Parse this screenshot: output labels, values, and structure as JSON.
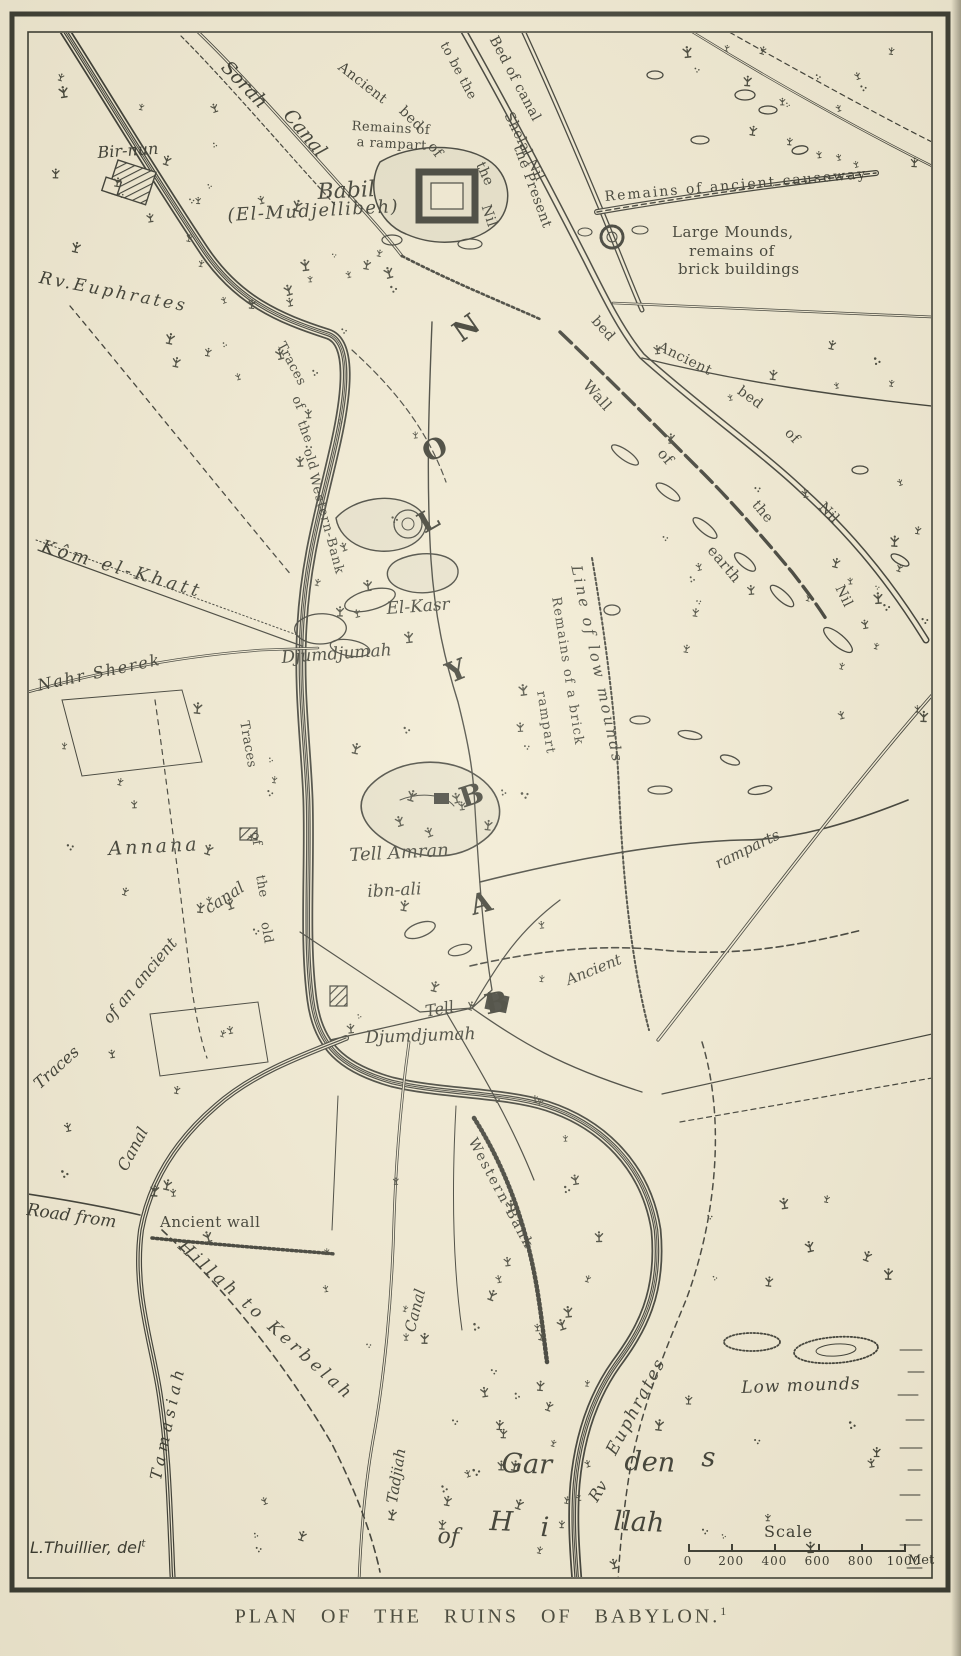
{
  "title_caption": {
    "text": "PLAN OF THE RUINS OF BABYLON.",
    "superscript": "1"
  },
  "credit": {
    "text": "L.Thuillier, del",
    "superscript": "t"
  },
  "scale_bar": {
    "label": "Scale",
    "ticks": [
      "0",
      "200",
      "400",
      "600",
      "800",
      "1000"
    ],
    "unit": "Met"
  },
  "colors": {
    "paper": "#f1ead3",
    "ink": "#30312a"
  },
  "map_labels": [
    {
      "t": "Sorah",
      "x": 231,
      "y": 58,
      "r": 46,
      "s": 19,
      "c": "ital"
    },
    {
      "t": "Canal",
      "x": 294,
      "y": 106,
      "r": 50,
      "s": 19,
      "c": "ital"
    },
    {
      "t": "Ancient",
      "x": 344,
      "y": 60,
      "r": 38,
      "s": 14,
      "c": "rom"
    },
    {
      "t": "bed",
      "x": 406,
      "y": 104,
      "r": 44,
      "s": 14,
      "c": "rom"
    },
    {
      "t": "of",
      "x": 436,
      "y": 140,
      "r": 52,
      "s": 14,
      "c": "rom"
    },
    {
      "t": "the",
      "x": 486,
      "y": 160,
      "r": 66,
      "s": 14,
      "c": "rom"
    },
    {
      "t": "Nil",
      "x": 492,
      "y": 203,
      "r": 72,
      "s": 14,
      "c": "rom"
    },
    {
      "t": "Bed of canal",
      "x": 499,
      "y": 34,
      "r": 62,
      "s": 14,
      "c": "rom"
    },
    {
      "t": "to be the",
      "x": 449,
      "y": 40,
      "r": 62,
      "s": 13,
      "c": "rom"
    },
    {
      "t": "Shelal Nil",
      "x": 514,
      "y": 110,
      "r": 64,
      "s": 14,
      "c": "rom"
    },
    {
      "t": "the Present",
      "x": 524,
      "y": 143,
      "r": 70,
      "s": 14,
      "c": "rom"
    },
    {
      "t": "Remains of",
      "x": 352,
      "y": 120,
      "r": 3,
      "s": 13,
      "c": "rom"
    },
    {
      "t": "a rampart",
      "x": 357,
      "y": 136,
      "r": 3,
      "s": 13,
      "c": "rom"
    },
    {
      "t": "Babil",
      "x": 317,
      "y": 182,
      "r": -3,
      "s": 22,
      "c": "ital"
    },
    {
      "t": "(El-Mudjellibeh)",
      "x": 227,
      "y": 207,
      "r": -3,
      "s": 18,
      "c": "ital",
      "ls": 1.5
    },
    {
      "t": "Bir-nun",
      "x": 97,
      "y": 145,
      "r": -4,
      "s": 16,
      "c": "ital"
    },
    {
      "t": "Remains of ancient causeway",
      "x": 604,
      "y": 190,
      "r": -5,
      "s": 14,
      "c": "rom",
      "ls": 2
    },
    {
      "t": "Large Mounds,",
      "x": 672,
      "y": 225,
      "r": 0,
      "s": 15,
      "c": "rom"
    },
    {
      "t": "remains of",
      "x": 689,
      "y": 244,
      "r": 0,
      "s": 15,
      "c": "rom"
    },
    {
      "t": "brick buildings",
      "x": 678,
      "y": 262,
      "r": 0,
      "s": 15,
      "c": "rom"
    },
    {
      "t": "Rv.Euphrates",
      "x": 41,
      "y": 270,
      "r": 11,
      "s": 17,
      "c": "ital",
      "ls": 3
    },
    {
      "t": "Traces",
      "x": 286,
      "y": 340,
      "r": 62,
      "s": 13,
      "c": "rom"
    },
    {
      "t": "of",
      "x": 301,
      "y": 394,
      "r": 66,
      "s": 13,
      "c": "rom"
    },
    {
      "t": "the",
      "x": 307,
      "y": 419,
      "r": 70,
      "s": 13,
      "c": "rom"
    },
    {
      "t": "old",
      "x": 313,
      "y": 447,
      "r": 72,
      "s": 13,
      "c": "rom"
    },
    {
      "t": "Western-Bank",
      "x": 319,
      "y": 472,
      "r": 75,
      "s": 13,
      "c": "rom",
      "ls": 1
    },
    {
      "t": "Kôm el-Khatt",
      "x": 44,
      "y": 538,
      "r": 16,
      "s": 18,
      "c": "ital",
      "ls": 4
    },
    {
      "t": "Nahr Sherek",
      "x": 36,
      "y": 678,
      "r": -12,
      "s": 16,
      "c": "ital",
      "ls": 2
    },
    {
      "t": "El-Kasr",
      "x": 386,
      "y": 601,
      "r": -4,
      "s": 17,
      "c": "ital"
    },
    {
      "t": "Djumdjumah",
      "x": 281,
      "y": 650,
      "r": -4,
      "s": 17,
      "c": "ital"
    },
    {
      "t": "Remains of a brick",
      "x": 562,
      "y": 596,
      "r": 81,
      "s": 13,
      "c": "rom",
      "ls": 1.5
    },
    {
      "t": "rampart",
      "x": 547,
      "y": 690,
      "r": 81,
      "s": 13,
      "c": "rom",
      "ls": 1.5
    },
    {
      "t": "Line of low mounds",
      "x": 583,
      "y": 564,
      "r": 78,
      "s": 15,
      "c": "ital",
      "ls": 3
    },
    {
      "t": "Wall",
      "x": 591,
      "y": 378,
      "r": 48,
      "s": 15,
      "c": "rom"
    },
    {
      "t": "of",
      "x": 666,
      "y": 446,
      "r": 50,
      "s": 15,
      "c": "rom"
    },
    {
      "t": "earth",
      "x": 716,
      "y": 543,
      "r": 50,
      "s": 15,
      "c": "rom"
    },
    {
      "t": "bed",
      "x": 599,
      "y": 314,
      "r": 48,
      "s": 14,
      "c": "rom"
    },
    {
      "t": "Ancient",
      "x": 662,
      "y": 340,
      "r": 26,
      "s": 14,
      "c": "rom"
    },
    {
      "t": "bed",
      "x": 743,
      "y": 384,
      "r": 36,
      "s": 14,
      "c": "rom"
    },
    {
      "t": "of",
      "x": 792,
      "y": 426,
      "r": 46,
      "s": 14,
      "c": "rom"
    },
    {
      "t": "the",
      "x": 760,
      "y": 498,
      "r": 50,
      "s": 14,
      "c": "rom"
    },
    {
      "t": "Nil",
      "x": 826,
      "y": 500,
      "r": 46,
      "s": 14,
      "c": "rom"
    },
    {
      "t": "Nil",
      "x": 845,
      "y": 583,
      "r": 64,
      "s": 14,
      "c": "rom"
    },
    {
      "t": "Annana",
      "x": 108,
      "y": 840,
      "r": -3,
      "s": 19,
      "c": "ital",
      "ls": 3
    },
    {
      "t": "Tell Amran",
      "x": 349,
      "y": 847,
      "r": -3,
      "s": 18,
      "c": "ital"
    },
    {
      "t": "ibn-ali",
      "x": 367,
      "y": 884,
      "r": -3,
      "s": 17,
      "c": "ital"
    },
    {
      "t": "Traces",
      "x": 250,
      "y": 720,
      "r": 80,
      "s": 13,
      "c": "rom"
    },
    {
      "t": "of",
      "x": 261,
      "y": 831,
      "r": 80,
      "s": 13,
      "c": "rom"
    },
    {
      "t": "the",
      "x": 266,
      "y": 874,
      "r": 80,
      "s": 13,
      "c": "rom"
    },
    {
      "t": "old",
      "x": 271,
      "y": 921,
      "r": 80,
      "s": 13,
      "c": "rom"
    },
    {
      "t": "canal",
      "x": 202,
      "y": 903,
      "r": -33,
      "s": 16,
      "c": "ital"
    },
    {
      "t": "of an ancient",
      "x": 100,
      "y": 1016,
      "r": -50,
      "s": 16,
      "c": "ital"
    },
    {
      "t": "Traces",
      "x": 31,
      "y": 1080,
      "r": -42,
      "s": 16,
      "c": "ital"
    },
    {
      "t": "ramparts",
      "x": 713,
      "y": 858,
      "r": -26,
      "s": 15,
      "c": "ital"
    },
    {
      "t": "Ancient",
      "x": 564,
      "y": 974,
      "r": -22,
      "s": 15,
      "c": "ital"
    },
    {
      "t": "Tell",
      "x": 424,
      "y": 1004,
      "r": -10,
      "s": 16,
      "c": "ital"
    },
    {
      "t": "Djumdjumah",
      "x": 365,
      "y": 1030,
      "r": -2,
      "s": 17,
      "c": "ital"
    },
    {
      "t": "Canal",
      "x": 115,
      "y": 1166,
      "r": -62,
      "s": 16,
      "c": "ital"
    },
    {
      "t": "Road from",
      "x": 28,
      "y": 1202,
      "r": 8,
      "s": 17,
      "c": "ital"
    },
    {
      "t": "Ancient wall",
      "x": 160,
      "y": 1215,
      "r": 0,
      "s": 15,
      "c": "rom"
    },
    {
      "t": "Hillah to Kerbelah",
      "x": 186,
      "y": 1238,
      "r": 42,
      "s": 17,
      "c": "ital",
      "ls": 4
    },
    {
      "t": "Tamasiah",
      "x": 148,
      "y": 1478,
      "r": -78,
      "s": 16,
      "c": "ital",
      "ls": 5
    },
    {
      "t": "Western-Bank",
      "x": 478,
      "y": 1136,
      "r": 62,
      "s": 14,
      "c": "rom",
      "ls": 2
    },
    {
      "t": "Canal",
      "x": 403,
      "y": 1330,
      "r": -76,
      "s": 15,
      "c": "ital"
    },
    {
      "t": "Tadjiah",
      "x": 385,
      "y": 1502,
      "r": -81,
      "s": 15,
      "c": "ital"
    },
    {
      "t": "Rv",
      "x": 586,
      "y": 1496,
      "r": -58,
      "s": 16,
      "c": "ital"
    },
    {
      "t": "Euphrates",
      "x": 604,
      "y": 1450,
      "r": -62,
      "s": 17,
      "c": "ital",
      "ls": 2
    },
    {
      "t": "Low mounds",
      "x": 741,
      "y": 1380,
      "r": -2,
      "s": 17,
      "c": "ital",
      "ls": 1
    },
    {
      "t": "Gar",
      "x": 502,
      "y": 1450,
      "r": 2,
      "s": 27,
      "c": "ital"
    },
    {
      "t": "den",
      "x": 625,
      "y": 1448,
      "r": 2,
      "s": 27,
      "c": "ital"
    },
    {
      "t": "s",
      "x": 702,
      "y": 1444,
      "r": 2,
      "s": 27,
      "c": "ital"
    },
    {
      "t": "of",
      "x": 438,
      "y": 1526,
      "r": 2,
      "s": 22,
      "c": "ital"
    },
    {
      "t": "H",
      "x": 490,
      "y": 1508,
      "r": 2,
      "s": 27,
      "c": "ital"
    },
    {
      "t": "i",
      "x": 541,
      "y": 1514,
      "r": 2,
      "s": 27,
      "c": "ital"
    },
    {
      "t": "llah",
      "x": 614,
      "y": 1508,
      "r": 2,
      "s": 27,
      "c": "ital"
    },
    {
      "t": "N",
      "x": 448,
      "y": 324,
      "r": -35,
      "s": 28,
      "c": "city"
    },
    {
      "t": "O",
      "x": 418,
      "y": 442,
      "r": -25,
      "s": 28,
      "c": "city"
    },
    {
      "t": "L",
      "x": 413,
      "y": 514,
      "r": -30,
      "s": 28,
      "c": "city"
    },
    {
      "t": "Y",
      "x": 442,
      "y": 662,
      "r": -22,
      "s": 28,
      "c": "city"
    },
    {
      "t": "B",
      "x": 456,
      "y": 786,
      "r": -18,
      "s": 28,
      "c": "city"
    },
    {
      "t": "A",
      "x": 467,
      "y": 893,
      "r": -15,
      "s": 28,
      "c": "city"
    },
    {
      "t": "B",
      "x": 482,
      "y": 992,
      "r": -12,
      "s": 28,
      "c": "city"
    }
  ]
}
